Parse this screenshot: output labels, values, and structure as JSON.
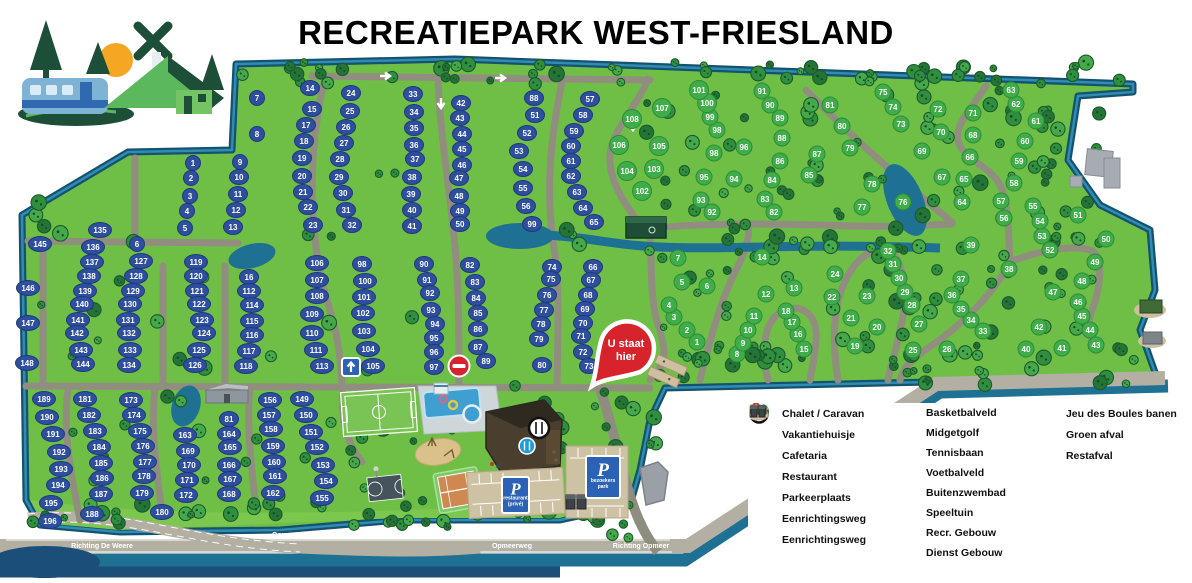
{
  "title": "RECREATIEPARK WEST-FRIESLAND",
  "marker": {
    "line1": "U staat",
    "line2": "hier"
  },
  "colors": {
    "park_green": "#6fbf47",
    "water": "#1e7193",
    "water_dark": "#1b4f79",
    "road": "#918e80",
    "road_light": "#b3b0a3",
    "badge_blue": "#2e4e9e",
    "badge_green": "#3fae49",
    "marker_red": "#d7232c",
    "sign_blue": "#2b62b5"
  },
  "road_labels": [
    {
      "text": "Richting De Weere",
      "x": 102,
      "y": 548
    },
    {
      "text": "Opmeerweg",
      "x": 292,
      "y": 537
    },
    {
      "text": "Opmeerweg",
      "x": 512,
      "y": 548
    },
    {
      "text": "De Dreef",
      "x": 560,
      "y": 536
    },
    {
      "text": "Richting Opmeer",
      "x": 641,
      "y": 548
    }
  ],
  "parking_signs": [
    {
      "letter": "P",
      "lines": [
        "restaurant",
        "(privé)"
      ],
      "x": 502,
      "y": 477,
      "w": 27,
      "h": 36
    },
    {
      "letter": "P",
      "lines": [
        "bezoekers",
        "park"
      ],
      "x": 586,
      "y": 456,
      "w": 34,
      "h": 42
    }
  ],
  "legend": {
    "columns": [
      [
        {
          "icon": "badge-blue",
          "badge": "10",
          "label": "Chalet / Caravan"
        },
        {
          "icon": "badge-green",
          "badge": "11",
          "label": "Vakantiehuisje"
        },
        {
          "icon": "cafetaria",
          "label": "Cafetaria"
        },
        {
          "icon": "restaurant",
          "label": "Restaurant"
        },
        {
          "icon": "parking",
          "label": "Parkeerplaats"
        },
        {
          "icon": "oneway-arrow",
          "label": "Eenrichtingsweg"
        },
        {
          "icon": "no-entry",
          "label": "Eenrichtingsweg"
        }
      ],
      [
        {
          "icon": "basketball",
          "label": "Basketbalveld"
        },
        {
          "icon": "midgetgolf",
          "label": "Midgetgolf"
        },
        {
          "icon": "tennis",
          "label": "Tennisbaan"
        },
        {
          "icon": "soccer",
          "label": "Voetbalveld"
        },
        {
          "icon": "pool",
          "label": "Buitenzwembad"
        },
        {
          "icon": "playground",
          "label": "Speeltuin"
        },
        {
          "icon": "building-recr",
          "label": "Recr. Gebouw"
        },
        {
          "icon": "building-dienst",
          "label": "Dienst Gebouw"
        }
      ],
      [
        {
          "icon": "boules",
          "label": "Jeu des Boules banen"
        },
        {
          "icon": "green-waste",
          "label": "Groen afval"
        },
        {
          "icon": "rest-waste",
          "label": "Restafval"
        }
      ]
    ]
  },
  "plots": {
    "chalet_caravan": [
      [
        1,
        193,
        163
      ],
      [
        2,
        191,
        178
      ],
      [
        3,
        190,
        196
      ],
      [
        4,
        187,
        211
      ],
      [
        5,
        185,
        228
      ],
      [
        6,
        137,
        244
      ],
      [
        7,
        257,
        98
      ],
      [
        8,
        257,
        134
      ],
      [
        9,
        240,
        162
      ],
      [
        10,
        239,
        177
      ],
      [
        11,
        238,
        194
      ],
      [
        12,
        236,
        210
      ],
      [
        13,
        233,
        227
      ],
      [
        14,
        310,
        88
      ],
      [
        15,
        312,
        109
      ],
      [
        16,
        249,
        277
      ],
      [
        17,
        306,
        125
      ],
      [
        18,
        304,
        141
      ],
      [
        19,
        302,
        158
      ],
      [
        20,
        302,
        176
      ],
      [
        21,
        303,
        192
      ],
      [
        22,
        308,
        207
      ],
      [
        23,
        313,
        225
      ],
      [
        24,
        351,
        93
      ],
      [
        25,
        350,
        111
      ],
      [
        26,
        346,
        127
      ],
      [
        27,
        344,
        143
      ],
      [
        28,
        340,
        159
      ],
      [
        29,
        339,
        177
      ],
      [
        30,
        343,
        193
      ],
      [
        31,
        346,
        210
      ],
      [
        32,
        352,
        225
      ],
      [
        33,
        413,
        94
      ],
      [
        34,
        414,
        112
      ],
      [
        35,
        414,
        128
      ],
      [
        36,
        414,
        145
      ],
      [
        37,
        415,
        159
      ],
      [
        38,
        412,
        177
      ],
      [
        39,
        411,
        194
      ],
      [
        40,
        412,
        210
      ],
      [
        41,
        412,
        226
      ],
      [
        42,
        461,
        103
      ],
      [
        43,
        460,
        118
      ],
      [
        44,
        462,
        134
      ],
      [
        45,
        462,
        149
      ],
      [
        46,
        462,
        165
      ],
      [
        47,
        459,
        178
      ],
      [
        48,
        459,
        196
      ],
      [
        49,
        460,
        211
      ],
      [
        50,
        460,
        224
      ],
      [
        51,
        535,
        115
      ],
      [
        52,
        527,
        133
      ],
      [
        53,
        519,
        151
      ],
      [
        54,
        523,
        169
      ],
      [
        55,
        523,
        188
      ],
      [
        56,
        526,
        206
      ],
      [
        57,
        590,
        99
      ],
      [
        58,
        583,
        115
      ],
      [
        59,
        574,
        131
      ],
      [
        60,
        571,
        146
      ],
      [
        61,
        571,
        161
      ],
      [
        62,
        571,
        176
      ],
      [
        63,
        577,
        192
      ],
      [
        64,
        583,
        208
      ],
      [
        65,
        594,
        222
      ],
      [
        66,
        593,
        267
      ],
      [
        67,
        591,
        280
      ],
      [
        68,
        588,
        295
      ],
      [
        69,
        585,
        309
      ],
      [
        70,
        583,
        323
      ],
      [
        71,
        581,
        336
      ],
      [
        72,
        583,
        352
      ],
      [
        73,
        589,
        366
      ],
      [
        74,
        552,
        267
      ],
      [
        75,
        551,
        279
      ],
      [
        76,
        547,
        295
      ],
      [
        77,
        544,
        310
      ],
      [
        78,
        541,
        324
      ],
      [
        79,
        539,
        339
      ],
      [
        80,
        542,
        365
      ],
      [
        81,
        229,
        419
      ],
      [
        82,
        470,
        265
      ],
      [
        83,
        475,
        282
      ],
      [
        84,
        476,
        298
      ],
      [
        85,
        478,
        313
      ],
      [
        86,
        478,
        329
      ],
      [
        87,
        478,
        347
      ],
      [
        88,
        534,
        98
      ],
      [
        89,
        486,
        361
      ],
      [
        90,
        424,
        264
      ],
      [
        91,
        427,
        280
      ],
      [
        92,
        430,
        293
      ],
      [
        93,
        431,
        310
      ],
      [
        94,
        435,
        324
      ],
      [
        95,
        434,
        338
      ],
      [
        96,
        434,
        352
      ],
      [
        97,
        434,
        367
      ],
      [
        98,
        362,
        264
      ],
      [
        99,
        532,
        224
      ],
      [
        100,
        365,
        281
      ],
      [
        101,
        364,
        297
      ],
      [
        102,
        363,
        313
      ],
      [
        103,
        364,
        331
      ],
      [
        104,
        368,
        349
      ],
      [
        105,
        373,
        366
      ],
      [
        106,
        317,
        263
      ],
      [
        107,
        317,
        280
      ],
      [
        108,
        317,
        296
      ],
      [
        109,
        312,
        314
      ],
      [
        110,
        312,
        333
      ],
      [
        111,
        316,
        350
      ],
      [
        112,
        249,
        291
      ],
      [
        113,
        322,
        366
      ],
      [
        114,
        252,
        305
      ],
      [
        115,
        252,
        321
      ],
      [
        116,
        252,
        335
      ],
      [
        117,
        249,
        351
      ],
      [
        118,
        246,
        366
      ],
      [
        119,
        196,
        262
      ],
      [
        120,
        196,
        276
      ],
      [
        121,
        197,
        291
      ],
      [
        122,
        199,
        304
      ],
      [
        123,
        202,
        320
      ],
      [
        124,
        204,
        333
      ],
      [
        125,
        199,
        350
      ],
      [
        126,
        195,
        365
      ],
      [
        127,
        141,
        261
      ],
      [
        128,
        136,
        276
      ],
      [
        129,
        133,
        291
      ],
      [
        130,
        130,
        304
      ],
      [
        131,
        128,
        320
      ],
      [
        132,
        129,
        333
      ],
      [
        133,
        130,
        350
      ],
      [
        134,
        129,
        365
      ],
      [
        135,
        100,
        230
      ],
      [
        136,
        93,
        247
      ],
      [
        137,
        92,
        262
      ],
      [
        138,
        89,
        276
      ],
      [
        139,
        85,
        291
      ],
      [
        140,
        82,
        304
      ],
      [
        141,
        78,
        320
      ],
      [
        142,
        77,
        333
      ],
      [
        143,
        81,
        350
      ],
      [
        144,
        83,
        364
      ],
      [
        145,
        40,
        244
      ],
      [
        146,
        28,
        288
      ],
      [
        147,
        28,
        323
      ],
      [
        148,
        27,
        363
      ],
      [
        149,
        302,
        399
      ],
      [
        150,
        306,
        415
      ],
      [
        151,
        311,
        432
      ],
      [
        152,
        317,
        447
      ],
      [
        153,
        323,
        465
      ],
      [
        154,
        326,
        481
      ],
      [
        155,
        322,
        498
      ],
      [
        156,
        270,
        400
      ],
      [
        157,
        269,
        415
      ],
      [
        158,
        271,
        429
      ],
      [
        159,
        273,
        446
      ],
      [
        160,
        274,
        462
      ],
      [
        161,
        275,
        476
      ],
      [
        162,
        273,
        493
      ],
      [
        163,
        185,
        435
      ],
      [
        164,
        229,
        434
      ],
      [
        165,
        230,
        447
      ],
      [
        166,
        229,
        465
      ],
      [
        167,
        230,
        479
      ],
      [
        168,
        229,
        494
      ],
      [
        169,
        188,
        451
      ],
      [
        170,
        189,
        465
      ],
      [
        171,
        187,
        480
      ],
      [
        172,
        186,
        495
      ],
      [
        173,
        131,
        400
      ],
      [
        174,
        134,
        415
      ],
      [
        175,
        140,
        431
      ],
      [
        176,
        143,
        446
      ],
      [
        177,
        145,
        462
      ],
      [
        178,
        144,
        476
      ],
      [
        179,
        142,
        493
      ],
      [
        180,
        162,
        512
      ],
      [
        181,
        85,
        399
      ],
      [
        182,
        89,
        415
      ],
      [
        183,
        95,
        431
      ],
      [
        184,
        99,
        447
      ],
      [
        185,
        101,
        463
      ],
      [
        186,
        102,
        478
      ],
      [
        187,
        101,
        494
      ],
      [
        188,
        92,
        514
      ],
      [
        189,
        44,
        399
      ],
      [
        190,
        47,
        417
      ],
      [
        191,
        53,
        434
      ],
      [
        192,
        59,
        452
      ],
      [
        193,
        61,
        469
      ],
      [
        194,
        58,
        485
      ],
      [
        195,
        51,
        503
      ],
      [
        196,
        50,
        521
      ]
    ],
    "vakantiehuisje": [
      [
        1,
        697,
        342
      ],
      [
        2,
        687,
        330
      ],
      [
        3,
        674,
        317
      ],
      [
        4,
        669,
        305
      ],
      [
        5,
        682,
        282
      ],
      [
        6,
        707,
        286
      ],
      [
        7,
        678,
        258
      ],
      [
        8,
        737,
        354
      ],
      [
        9,
        743,
        343
      ],
      [
        10,
        748,
        330
      ],
      [
        11,
        754,
        316
      ],
      [
        12,
        766,
        294
      ],
      [
        13,
        794,
        288
      ],
      [
        14,
        762,
        257
      ],
      [
        15,
        804,
        349
      ],
      [
        16,
        798,
        334
      ],
      [
        17,
        792,
        322
      ],
      [
        18,
        786,
        311
      ],
      [
        19,
        855,
        346
      ],
      [
        20,
        877,
        327
      ],
      [
        21,
        851,
        318
      ],
      [
        22,
        832,
        297
      ],
      [
        23,
        867,
        296
      ],
      [
        24,
        835,
        274
      ],
      [
        25,
        913,
        350
      ],
      [
        26,
        947,
        349
      ],
      [
        27,
        919,
        324
      ],
      [
        28,
        912,
        305
      ],
      [
        29,
        905,
        292
      ],
      [
        30,
        899,
        278
      ],
      [
        31,
        893,
        264
      ],
      [
        32,
        888,
        251
      ],
      [
        33,
        983,
        331
      ],
      [
        34,
        971,
        320
      ],
      [
        35,
        961,
        309
      ],
      [
        36,
        952,
        295
      ],
      [
        37,
        961,
        279
      ],
      [
        38,
        1009,
        269
      ],
      [
        39,
        971,
        245
      ],
      [
        40,
        1026,
        349
      ],
      [
        41,
        1062,
        348
      ],
      [
        42,
        1039,
        327
      ],
      [
        43,
        1096,
        345
      ],
      [
        44,
        1090,
        330
      ],
      [
        45,
        1082,
        316
      ],
      [
        46,
        1078,
        302
      ],
      [
        47,
        1053,
        292
      ],
      [
        48,
        1082,
        281
      ],
      [
        49,
        1095,
        262
      ],
      [
        50,
        1106,
        239
      ],
      [
        51,
        1078,
        215
      ],
      [
        52,
        1050,
        250
      ],
      [
        53,
        1042,
        236
      ],
      [
        54,
        1040,
        221
      ],
      [
        55,
        1033,
        206
      ],
      [
        56,
        1004,
        218
      ],
      [
        57,
        1001,
        201
      ],
      [
        58,
        1014,
        183
      ],
      [
        59,
        1019,
        161
      ],
      [
        60,
        1025,
        141
      ],
      [
        61,
        1036,
        121
      ],
      [
        62,
        1016,
        104
      ],
      [
        63,
        1011,
        90
      ],
      [
        64,
        962,
        202
      ],
      [
        65,
        964,
        179
      ],
      [
        66,
        970,
        157
      ],
      [
        67,
        942,
        177
      ],
      [
        68,
        973,
        135
      ],
      [
        69,
        922,
        151
      ],
      [
        70,
        941,
        132
      ],
      [
        71,
        973,
        113
      ],
      [
        72,
        938,
        109
      ],
      [
        73,
        901,
        124
      ],
      [
        74,
        893,
        107
      ],
      [
        75,
        883,
        92
      ],
      [
        76,
        903,
        202
      ],
      [
        77,
        862,
        207
      ],
      [
        78,
        872,
        184
      ],
      [
        79,
        850,
        148
      ],
      [
        80,
        842,
        126
      ],
      [
        81,
        830,
        105
      ],
      [
        82,
        774,
        212
      ],
      [
        83,
        765,
        199
      ],
      [
        84,
        772,
        180
      ],
      [
        85,
        809,
        175
      ],
      [
        86,
        780,
        161
      ],
      [
        87,
        817,
        154
      ],
      [
        88,
        782,
        138
      ],
      [
        89,
        780,
        118
      ],
      [
        90,
        770,
        105
      ],
      [
        91,
        762,
        91
      ],
      [
        92,
        712,
        212
      ],
      [
        93,
        701,
        200
      ],
      [
        94,
        734,
        179
      ],
      [
        95,
        704,
        177
      ],
      [
        96,
        744,
        147
      ],
      [
        98,
        717,
        130
      ],
      [
        98,
        714,
        153
      ],
      [
        99,
        710,
        117
      ],
      [
        100,
        707,
        103
      ],
      [
        101,
        699,
        90
      ],
      [
        102,
        642,
        191
      ],
      [
        103,
        654,
        169
      ],
      [
        104,
        627,
        171
      ],
      [
        105,
        659,
        146
      ],
      [
        106,
        619,
        145
      ],
      [
        107,
        662,
        108
      ],
      [
        108,
        632,
        119
      ]
    ]
  }
}
